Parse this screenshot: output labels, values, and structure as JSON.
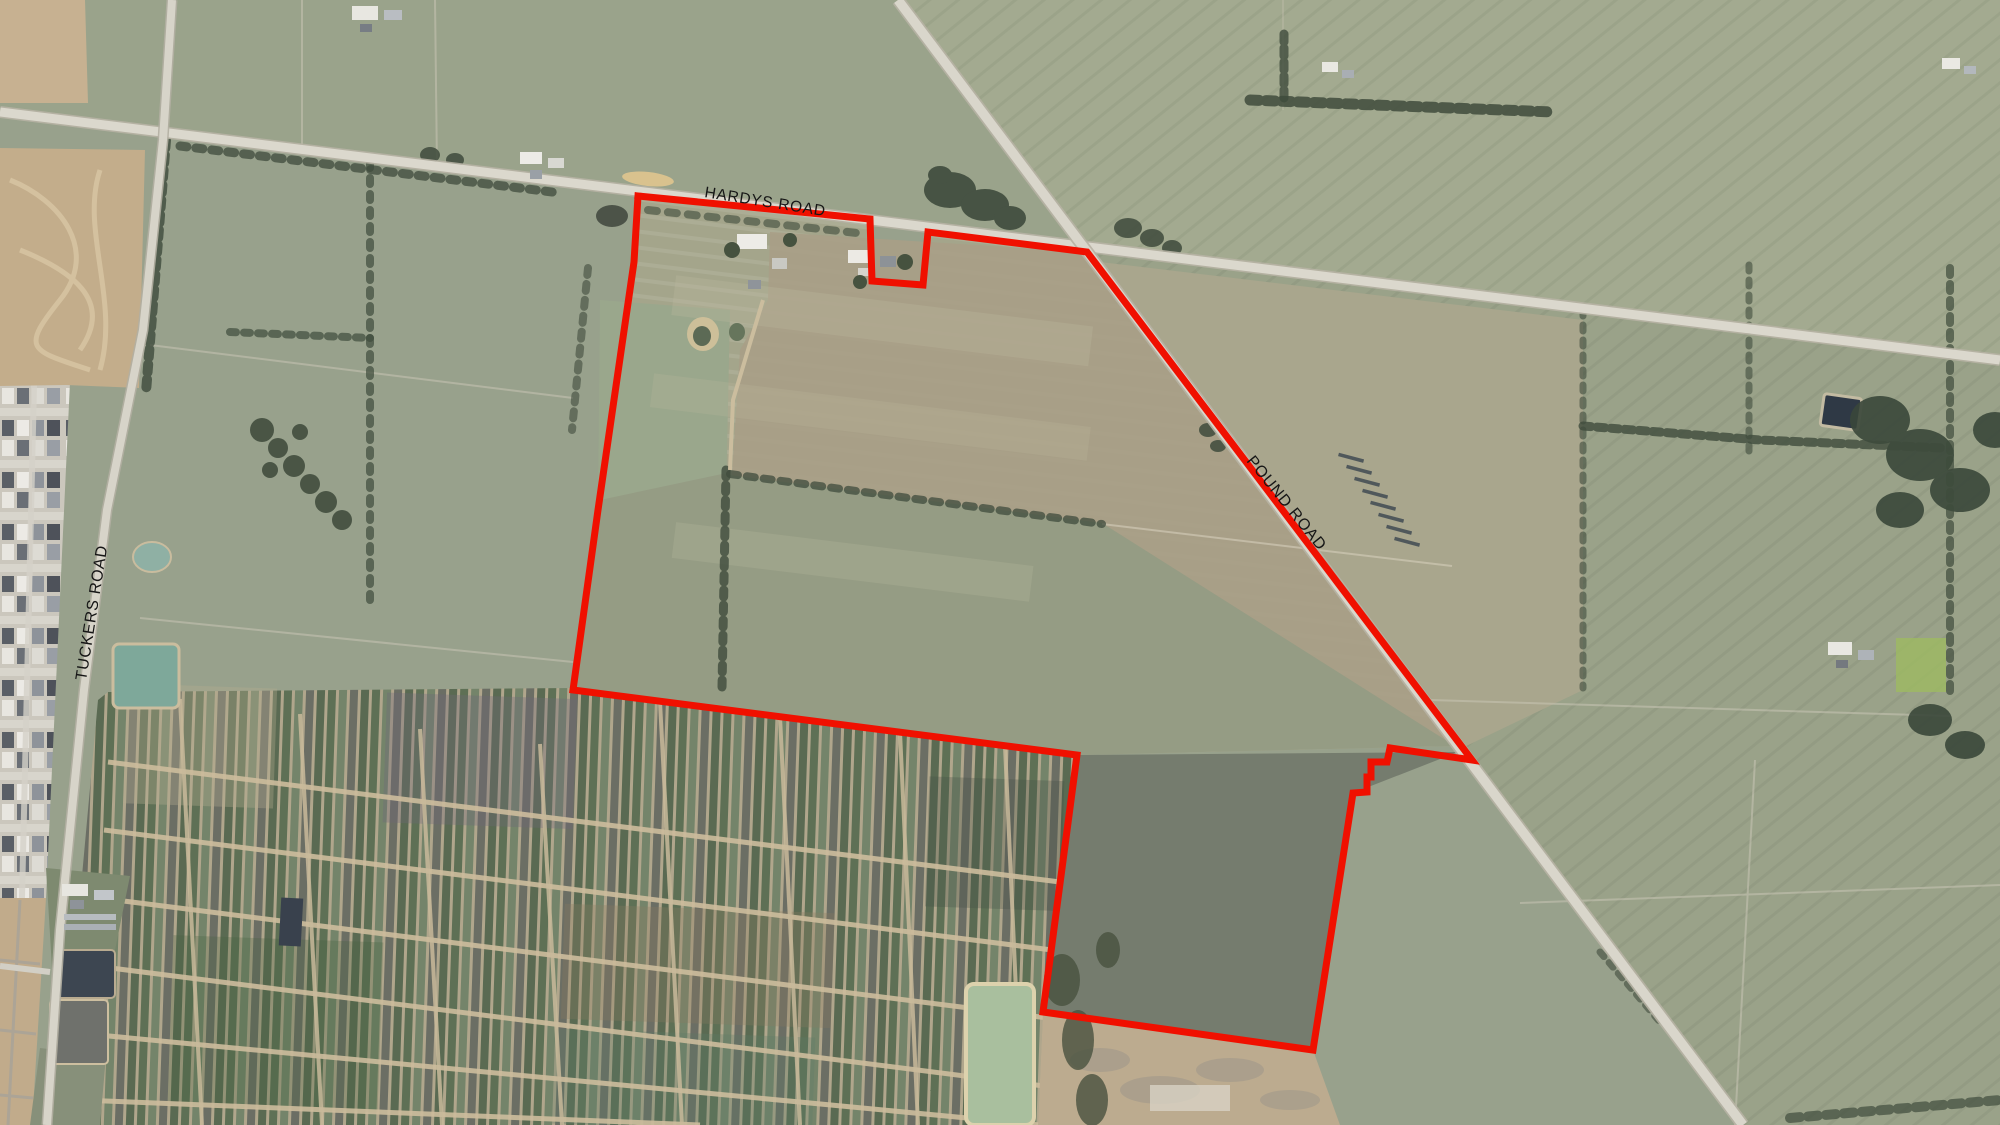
{
  "map": {
    "description": "Aerial photograph with property boundary overlay",
    "road_labels": [
      {
        "id": "hardys-road",
        "text": "HARDYS ROAD",
        "x": 704,
        "y": 197,
        "rotation": 9,
        "font_size": 15.5,
        "letter_spacing": 0.8,
        "color": "#161616"
      },
      {
        "id": "pound-road",
        "text": "POUND ROAD",
        "x": 1246,
        "y": 461,
        "rotation": 51,
        "font_size": 16,
        "letter_spacing": 0.8,
        "color": "#161616"
      },
      {
        "id": "tuckers-road",
        "text": "TUCKERS ROAD",
        "x": 86,
        "y": 681,
        "rotation": -81,
        "font_size": 16,
        "letter_spacing": 0.8,
        "color": "#161616"
      }
    ],
    "property_boundary": {
      "color": "#f01000",
      "stroke_width": 7,
      "points": "638,196 870,219 872,281 923,285 928,232 1087,252 1472,760 1390,748 1387,762 1371,762 1371,777 1367,777 1367,792 1353,793 1313,1050 1043,1012 1077,755 573,690 598,510 634,262 638,196"
    }
  }
}
